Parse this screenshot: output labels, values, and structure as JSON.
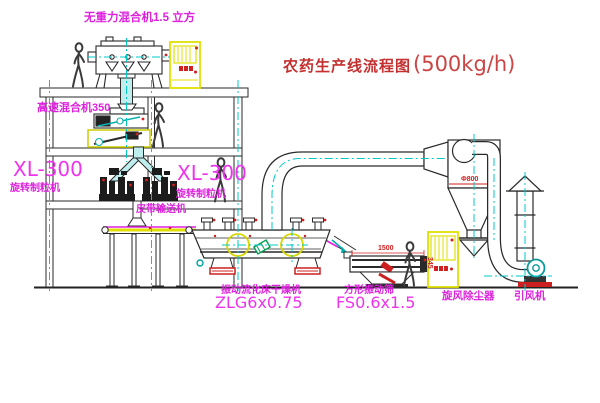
{
  "title": {
    "main": "农药生产线流程图",
    "capacity": "(500kg/h)"
  },
  "labels": {
    "top_mixer": "无重力混合机1.5 立方",
    "high_speed_mixer": "高速混合机350",
    "granulator_left_model": "XL-300",
    "granulator_left_name": "旋转制粒机",
    "granulator_right_model": "XL-300",
    "granulator_right_name": "旋转制粒机",
    "belt_conveyor": "皮带输送机",
    "dryer_name": "振动流化床干燥机",
    "dryer_model": "ZLG6x0.75",
    "screen_name": "方形振动筛",
    "screen_model": "FS0.6x1.5",
    "cyclone": "旋风除尘器",
    "fan": "引风机"
  },
  "dimensions": {
    "screen_length": "1500",
    "screen_side": "345",
    "cyclone_diameter": "Φ800"
  },
  "colors": {
    "line": "#2a2a2a",
    "centerline": "#00c8c8",
    "label_magenta": "#dd22dd",
    "dimension_red": "#d02020",
    "title_red": "#c43030",
    "cabinet_yellow": "#e0e000",
    "fan_teal": "#0a9a9a",
    "chute_fill": "#bfeeee",
    "motor_green": "#00a050"
  }
}
